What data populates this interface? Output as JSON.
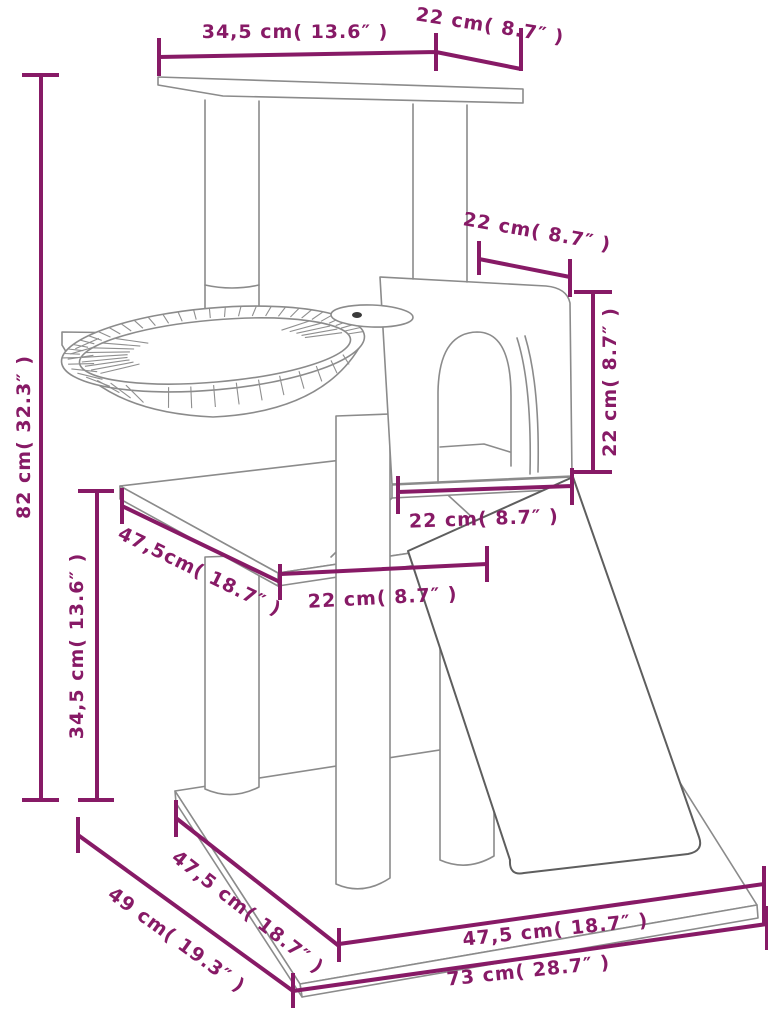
{
  "diagram": {
    "colors": {
      "dimension": "#871A66",
      "outline": "#8B8B8B",
      "outline_dark": "#5E5E5E",
      "background": "#FFFFFF"
    },
    "labels": {
      "top_platform_depth": "34,5 cm( 13.6″ )",
      "top_platform_width": "22 cm( 8.7″ )",
      "total_height": "82 cm( 32.3″ )",
      "condo_roof_depth": "22 cm( 8.7″ )",
      "condo_height": "22 cm( 8.7″ )",
      "condo_base_depth": "22 cm( 8.7″ )",
      "middle_platform_depth": "47,5cm( 18.7″ )",
      "middle_platform_width": "22 cm( 8.7″ )",
      "lower_section_height": "34,5 cm( 13.6″ )",
      "base_side_depth": "47,5 cm( 18.7″ )",
      "base_total_depth": "49 cm( 19.3″ )",
      "base_front_width": "47,5 cm( 18.7″ )",
      "base_total_width": "73 cm( 28.7″ )"
    }
  }
}
